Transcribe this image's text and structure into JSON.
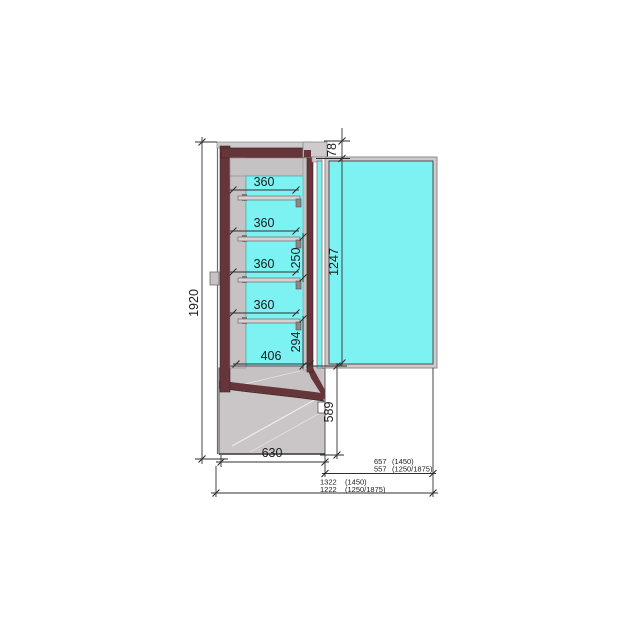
{
  "drawing": {
    "type": "refrigerated-display-cabinet-side-section",
    "dims": {
      "overall_height": "1920",
      "shelves": [
        "360",
        "360",
        "360",
        "360"
      ],
      "shelf_pitch": "250",
      "lower_gap": "294",
      "well_depth": "406",
      "top_recess": "78",
      "door_height": "1247",
      "base_front_height": "589",
      "base_depth": "630",
      "door_open_proj": {
        "value": "657",
        "variant": "(1450)"
      },
      "door_open_proj_alt": {
        "value": "557",
        "variant": "(1250/1875)"
      },
      "total_depth_open": {
        "value": "1322",
        "variant": "(1450)"
      },
      "total_depth_open_alt": {
        "value": "1222",
        "variant": "(1250/1875)"
      }
    },
    "colors": {
      "glass": "#7df2f2",
      "insulation_frame": "#653539",
      "metal_liner": "#c6c1c2",
      "line": "#2f2f2f"
    }
  }
}
